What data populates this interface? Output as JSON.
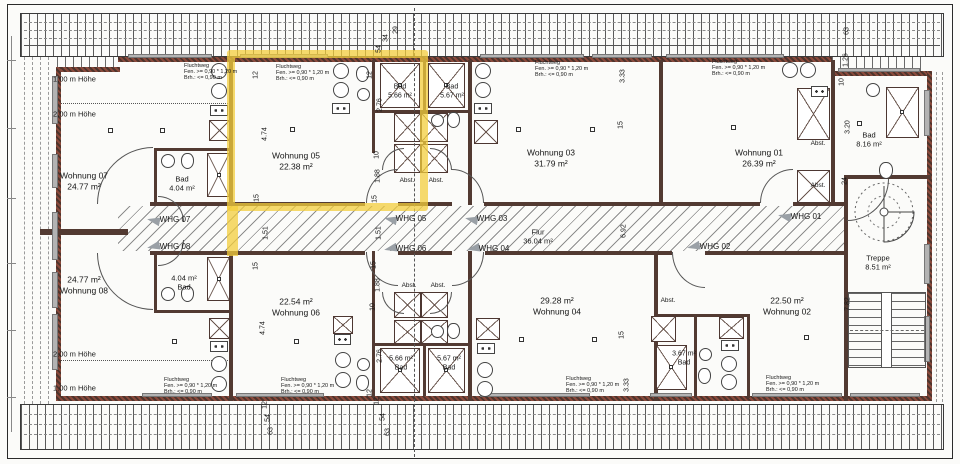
{
  "rooms": [
    {
      "label": "Wohnung 01",
      "area": "26.39 m²"
    },
    {
      "label": "Wohnung 02",
      "area": "22.50 m²"
    },
    {
      "label": "Wohnung 03",
      "area": "31.79 m²"
    },
    {
      "label": "Wohnung 04",
      "area": "29.28 m²"
    },
    {
      "label": "Wohnung 05",
      "area": "22.38 m²"
    },
    {
      "label": "Wohnung 06",
      "area": "22.54 m²"
    },
    {
      "label": "Wohnung 07",
      "area": "24.77 m²"
    },
    {
      "label": "Wohnung 08",
      "area": "24.77 m²"
    },
    {
      "label": "Flur",
      "area": "36.04 m²"
    },
    {
      "label": "Treppe",
      "area": "8.51 m²"
    },
    {
      "label": "Bad",
      "area": "4.04 m²"
    },
    {
      "label": "Bad",
      "area": "5.66 m²"
    },
    {
      "label": "Bad",
      "area": "5.67 m²"
    },
    {
      "label": "Bad",
      "area": "8.16 m²"
    },
    {
      "label": "Bad",
      "area": "3.67 m²"
    }
  ],
  "corridor_doors": [
    "WHG 01",
    "WHG 02",
    "WHG 03",
    "WHG 04",
    "WHG 05",
    "WHG 06",
    "WHG 07",
    "WHG 08"
  ],
  "escape_note": "Fluchtweg\nFen. >= 0,90 * 1,20 m\nBrh.: <= 0,90 m",
  "height_marks": [
    "1,00 m Höhe",
    "2,00 m Höhe"
  ],
  "highlight": {
    "unit": "Wohnung 05",
    "color": "#F3CD3C"
  },
  "labels": [
    {
      "n": "wohnung-07",
      "t": "Wohnung 07\n24.77 m²",
      "x": 84,
      "y": 181
    },
    {
      "n": "bad-wohnung-07",
      "t": "Bad\n4.04 m²",
      "x": 182,
      "y": 184,
      "s": 7.5
    },
    {
      "n": "wohnung-05",
      "t": "Wohnung 05\n22.38 m²",
      "x": 296,
      "y": 161
    },
    {
      "n": "bad-wohnung-05",
      "t": "Bad\n5.66 m²",
      "x": 400,
      "y": 92,
      "s": 7
    },
    {
      "n": "bad-wohnung-03",
      "t": "Bad\n5.67 m²",
      "x": 452,
      "y": 92,
      "s": 7
    },
    {
      "n": "wohnung-03",
      "t": "Wohnung 03\n31.79 m²",
      "x": 551,
      "y": 158
    },
    {
      "n": "wohnung-01",
      "t": "Wohnung 01\n26.39 m²",
      "x": 759,
      "y": 158
    },
    {
      "n": "bad-wohnung-01",
      "t": "Bad\n8.16 m²",
      "x": 869,
      "y": 140,
      "s": 7.5
    },
    {
      "n": "treppe",
      "t": "Treppe\n8.51 m²",
      "x": 878,
      "y": 263,
      "s": 7.5
    },
    {
      "n": "flur",
      "t": "Flur\n36.04 m²",
      "x": 538,
      "y": 237,
      "s": 7.5
    },
    {
      "n": "wohnung-08",
      "t": "24.77 m²\nWohnung 08",
      "x": 84,
      "y": 285
    },
    {
      "n": "bad-wohnung-08",
      "t": "4.04 m²\nBad",
      "x": 184,
      "y": 283,
      "s": 7.5
    },
    {
      "n": "wohnung-06",
      "t": "22.54 m²\nWohnung 06",
      "x": 296,
      "y": 307
    },
    {
      "n": "bad-wohnung-06",
      "t": "5.66 m²\nBad",
      "x": 401,
      "y": 364,
      "s": 7
    },
    {
      "n": "bad-wohnung-04",
      "t": "5.67 m²\nBad",
      "x": 449,
      "y": 364,
      "s": 7
    },
    {
      "n": "wohnung-04",
      "t": "29.28 m²\nWohnung 04",
      "x": 557,
      "y": 306
    },
    {
      "n": "wohnung-02",
      "t": "22.50 m²\nWohnung 02",
      "x": 787,
      "y": 306
    },
    {
      "n": "bad-wohnung-02",
      "t": "3.67 m²\nBad",
      "x": 684,
      "y": 359,
      "s": 7
    },
    {
      "n": "whg-07-door",
      "t": "WHG 07",
      "x": 175,
      "y": 220,
      "s": 8
    },
    {
      "n": "whg-08-door",
      "t": "WHG 08",
      "x": 175,
      "y": 247,
      "s": 8
    },
    {
      "n": "whg-05-door",
      "t": "WHG 05",
      "x": 411,
      "y": 219,
      "s": 8
    },
    {
      "n": "whg-06-door",
      "t": "WHG 06",
      "x": 411,
      "y": 249,
      "s": 8
    },
    {
      "n": "whg-03-door",
      "t": "WHG 03",
      "x": 492,
      "y": 219,
      "s": 8
    },
    {
      "n": "whg-04-door",
      "t": "WHG 04",
      "x": 494,
      "y": 249,
      "s": 8
    },
    {
      "n": "whg-01-door",
      "t": "WHG 01",
      "x": 806,
      "y": 217,
      "s": 8
    },
    {
      "n": "whg-02-door",
      "t": "WHG 02",
      "x": 715,
      "y": 247,
      "s": 8
    },
    {
      "n": "abstellraum",
      "t": "Abst.",
      "x": 407,
      "y": 181,
      "s": 6.5
    },
    {
      "n": "abstellraum",
      "t": "Abst.",
      "x": 436,
      "y": 181,
      "s": 6.5
    },
    {
      "n": "abstellraum",
      "t": "Abst.",
      "x": 409,
      "y": 286,
      "s": 6.5
    },
    {
      "n": "abstellraum",
      "t": "Abst.",
      "x": 438,
      "y": 286,
      "s": 6.5
    },
    {
      "n": "abstellraum",
      "t": "Abst.",
      "x": 668,
      "y": 301,
      "s": 6.5
    },
    {
      "n": "abstellraum",
      "t": "Abst.",
      "x": 818,
      "y": 144,
      "s": 6.5
    },
    {
      "n": "abstellraum",
      "t": "Abst.",
      "x": 818,
      "y": 186,
      "s": 6.5
    },
    {
      "n": "height-mark",
      "t": "1,00 m Höhe",
      "x": 53,
      "y": 79,
      "s": 7.5,
      "a": "l"
    },
    {
      "n": "height-mark",
      "t": "2,00 m Höhe",
      "x": 53,
      "y": 114,
      "s": 7.5,
      "a": "l"
    },
    {
      "n": "height-mark",
      "t": "2,00 m Höhe",
      "x": 53,
      "y": 354,
      "s": 7.5,
      "a": "l"
    },
    {
      "n": "height-mark",
      "t": "1,00 m Höhe",
      "x": 53,
      "y": 388,
      "s": 7.5,
      "a": "l"
    },
    {
      "n": "escape-route-note",
      "t": "Fluchtweg\nFen. >= 0,90 * 1,20 m\nBrh.: <= 0,90 m",
      "x": 184,
      "y": 72,
      "s": 5.5,
      "a": "l",
      "lh": 1.1
    },
    {
      "n": "escape-route-note",
      "t": "Fluchtweg\nFen. >= 0,90 * 1,20 m\nBrh.: <= 0,90 m",
      "x": 276,
      "y": 73,
      "s": 5.5,
      "a": "l",
      "lh": 1.1
    },
    {
      "n": "escape-route-note",
      "t": "Fluchtweg\nFen. >= 0,90 * 1,20 m\nBrh.: <= 0,90 m",
      "x": 535,
      "y": 69,
      "s": 5.5,
      "a": "l",
      "lh": 1.1
    },
    {
      "n": "escape-route-note",
      "t": "Fluchtweg\nFen. >= 0,90 * 1,20 m\nBrh.: <= 0,90 m",
      "x": 712,
      "y": 68,
      "s": 5.5,
      "a": "l",
      "lh": 1.1
    },
    {
      "n": "escape-route-note",
      "t": "Fluchtweg\nFen. >= 0,90 * 1,20 m\nBrh.: <= 0,90 m",
      "x": 164,
      "y": 386,
      "s": 5.5,
      "a": "l",
      "lh": 1.1
    },
    {
      "n": "escape-route-note",
      "t": "Fluchtweg\nFen. >= 0,90 * 1,20 m\nBrh.: <= 0,90 m",
      "x": 281,
      "y": 386,
      "s": 5.5,
      "a": "l",
      "lh": 1.1
    },
    {
      "n": "escape-route-note",
      "t": "Fluchtweg\nFen. >= 0,90 * 1,20 m\nBrh.: <= 0,90 m",
      "x": 566,
      "y": 385,
      "s": 5.5,
      "a": "l",
      "lh": 1.1
    },
    {
      "n": "escape-route-note",
      "t": "Fluchtweg\nFen. >= 0,90 * 1,20 m\nBrh.: <= 0,90 m",
      "x": 766,
      "y": 384,
      "s": 5.5,
      "a": "l",
      "lh": 1.1
    },
    {
      "n": "dimension",
      "t": "12",
      "x": 257,
      "y": 75,
      "s": 7,
      "r": 1
    },
    {
      "n": "dimension",
      "t": "4.74",
      "x": 266,
      "y": 134,
      "s": 7,
      "r": 1
    },
    {
      "n": "dimension",
      "t": "15",
      "x": 258,
      "y": 198,
      "s": 7,
      "r": 1
    },
    {
      "n": "dimension",
      "t": "1.51",
      "x": 267,
      "y": 233,
      "s": 7,
      "r": 1
    },
    {
      "n": "dimension",
      "t": "15",
      "x": 257,
      "y": 266,
      "s": 7,
      "r": 1
    },
    {
      "n": "dimension",
      "t": "4.74",
      "x": 264,
      "y": 328,
      "s": 7,
      "r": 1
    },
    {
      "n": "dimension",
      "t": "12",
      "x": 266,
      "y": 405,
      "s": 7,
      "r": 1
    },
    {
      "n": "dimension",
      "t": "54",
      "x": 269,
      "y": 418,
      "s": 7,
      "r": 1
    },
    {
      "n": "dimension",
      "t": "63",
      "x": 272,
      "y": 431,
      "s": 7,
      "r": 1
    },
    {
      "n": "dimension",
      "t": "12",
      "x": 371,
      "y": 75,
      "s": 7,
      "r": 1
    },
    {
      "n": "dimension",
      "t": "2.76",
      "x": 381,
      "y": 105,
      "s": 7,
      "r": 1
    },
    {
      "n": "dimension",
      "t": "10",
      "x": 378,
      "y": 155,
      "s": 7,
      "r": 1
    },
    {
      "n": "dimension",
      "t": "1.88",
      "x": 379,
      "y": 176,
      "s": 7,
      "r": 1
    },
    {
      "n": "dimension",
      "t": "15",
      "x": 376,
      "y": 199,
      "s": 7,
      "r": 1
    },
    {
      "n": "dimension",
      "t": "1.51",
      "x": 380,
      "y": 233,
      "s": 7,
      "r": 1
    },
    {
      "n": "dimension",
      "t": "15",
      "x": 375,
      "y": 265,
      "s": 7,
      "r": 1
    },
    {
      "n": "dimension",
      "t": "1.88",
      "x": 379,
      "y": 285,
      "s": 7,
      "r": 1
    },
    {
      "n": "dimension",
      "t": "10",
      "x": 374,
      "y": 307,
      "s": 7,
      "r": 1
    },
    {
      "n": "dimension",
      "t": "2.76",
      "x": 381,
      "y": 356,
      "s": 7,
      "r": 1
    },
    {
      "n": "dimension",
      "t": "12",
      "x": 371,
      "y": 393,
      "s": 7,
      "r": 1
    },
    {
      "n": "dimension",
      "t": "29",
      "x": 397,
      "y": 30,
      "s": 7,
      "r": 1
    },
    {
      "n": "dimension",
      "t": "34",
      "x": 387,
      "y": 38,
      "s": 7,
      "r": 1
    },
    {
      "n": "dimension",
      "t": "54",
      "x": 380,
      "y": 49,
      "s": 7,
      "r": 1
    },
    {
      "n": "dimension",
      "t": "12",
      "x": 378,
      "y": 401,
      "s": 7,
      "r": 1
    },
    {
      "n": "dimension",
      "t": "54",
      "x": 384,
      "y": 417,
      "s": 7,
      "r": 1
    },
    {
      "n": "dimension",
      "t": "63",
      "x": 389,
      "y": 432,
      "s": 7,
      "r": 1
    },
    {
      "n": "dimension",
      "t": "3.33",
      "x": 624,
      "y": 76,
      "s": 7,
      "r": 1
    },
    {
      "n": "dimension",
      "t": "15",
      "x": 622,
      "y": 125,
      "s": 7,
      "r": 1
    },
    {
      "n": "dimension",
      "t": "6.92",
      "x": 625,
      "y": 231,
      "s": 7,
      "r": 1
    },
    {
      "n": "dimension",
      "t": "15",
      "x": 623,
      "y": 335,
      "s": 7,
      "r": 1
    },
    {
      "n": "dimension",
      "t": "3.33",
      "x": 628,
      "y": 385,
      "s": 7,
      "r": 1
    },
    {
      "n": "dimension",
      "t": "63",
      "x": 848,
      "y": 31,
      "s": 7,
      "r": 1
    },
    {
      "n": "dimension",
      "t": "1.26",
      "x": 847,
      "y": 60,
      "s": 7,
      "r": 1
    },
    {
      "n": "dimension",
      "t": "10",
      "x": 843,
      "y": 82,
      "s": 7,
      "r": 1
    },
    {
      "n": "dimension",
      "t": "3.20",
      "x": 849,
      "y": 127,
      "s": 7,
      "r": 1
    },
    {
      "n": "dimension",
      "t": "24",
      "x": 846,
      "y": 181,
      "s": 7,
      "r": 1
    },
    {
      "n": "dimension",
      "t": "7.82",
      "x": 849,
      "y": 304,
      "s": 7,
      "r": 1
    }
  ]
}
